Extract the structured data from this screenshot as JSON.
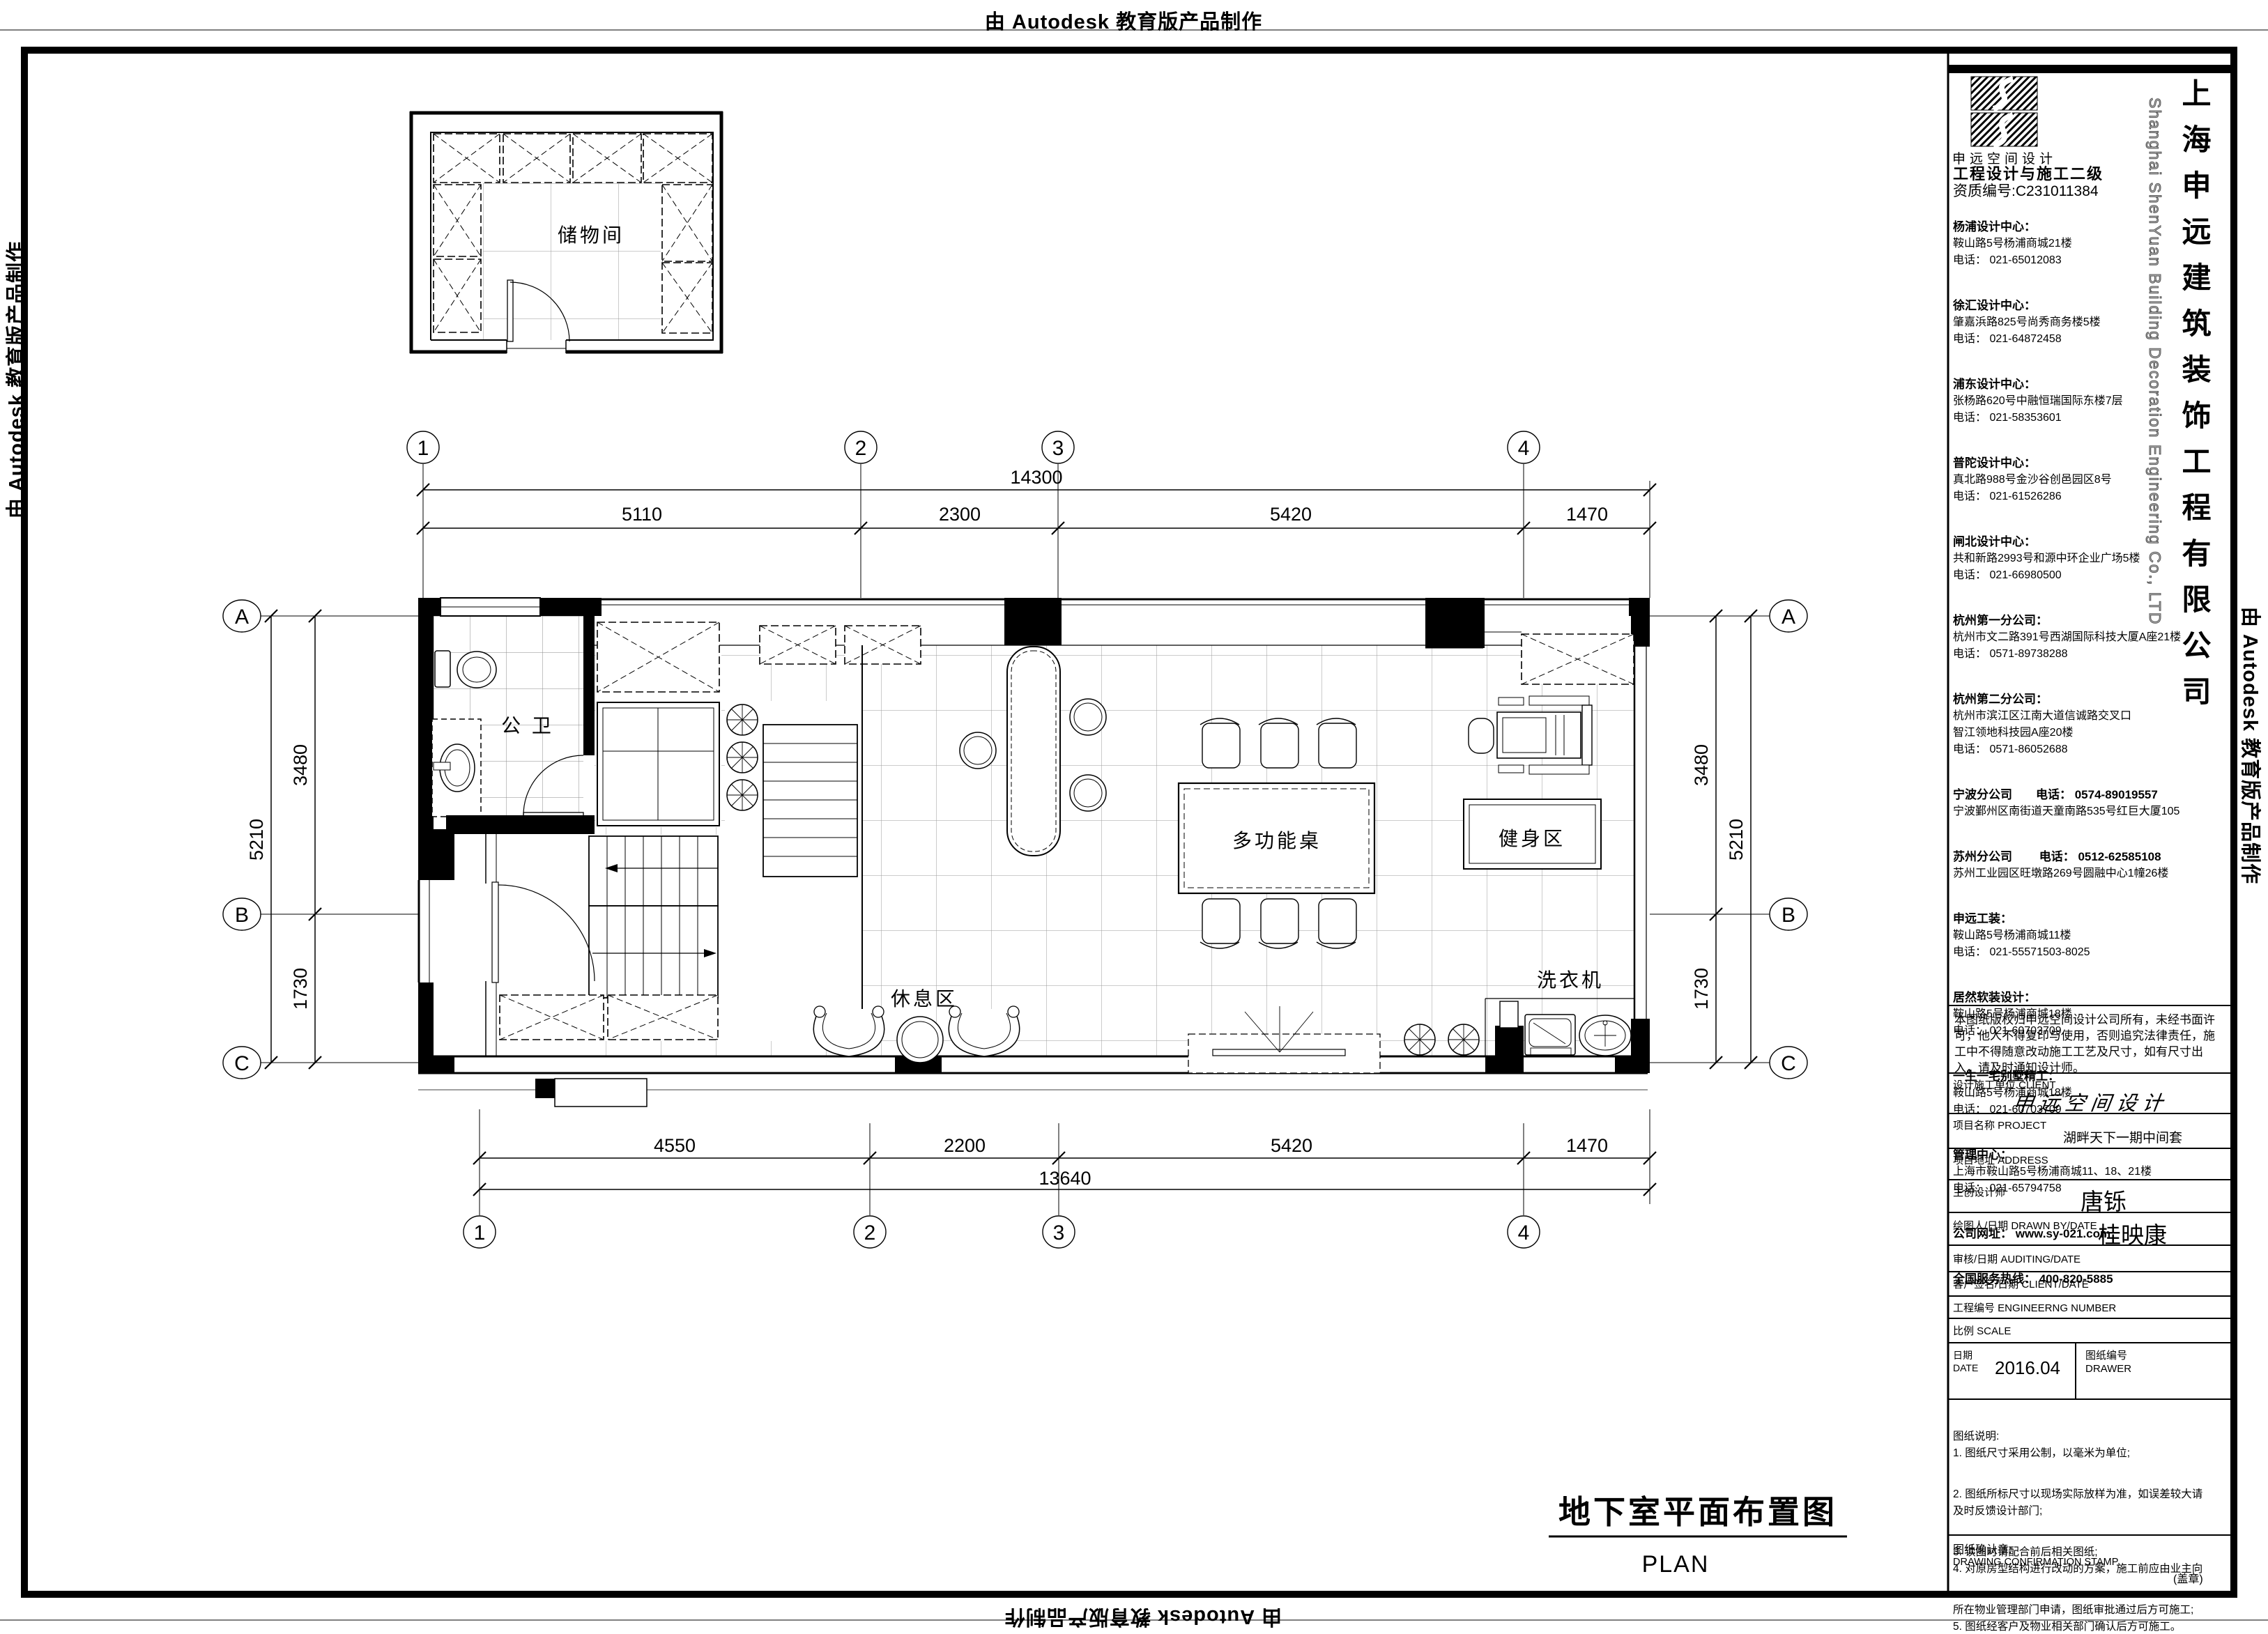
{
  "watermark": {
    "text": "由 Autodesk 教育版产品制作"
  },
  "sheet": {
    "title": "地下室平面布置图",
    "subtitle": "PLAN"
  },
  "plan": {
    "rooms": {
      "storage": "储物间",
      "bath": "公 卫",
      "table": "多功能桌",
      "gym": "健身区",
      "rest": "休息区",
      "washer": "洗衣机"
    },
    "grid": {
      "cols": [
        "1",
        "2",
        "3",
        "4"
      ],
      "rows": [
        "A",
        "B",
        "C"
      ]
    },
    "dims": {
      "top": {
        "overall": "14300",
        "segs": [
          "5110",
          "2300",
          "5420",
          "1470"
        ]
      },
      "bottom": {
        "overall": "13640",
        "segs": [
          "4550",
          "2200",
          "5420",
          "1470"
        ]
      },
      "left": {
        "overall": "5210",
        "segs": [
          "3480",
          "1730"
        ]
      },
      "right": {
        "overall": "5210",
        "segs": [
          "3480",
          "1730"
        ]
      }
    }
  },
  "title_block": {
    "logo_caption": "申远空间设计",
    "cert_line1": "工程设计与施工二级",
    "cert_line2": "资质编号:C231011384",
    "company_cn": "上海申远建筑装饰工程有限公司",
    "company_en": "Shanghai ShenYuan Building Decoration Engineering Co., LTD",
    "offices": [
      {
        "t": "杨浦设计中心：",
        "lines": [
          "鞍山路5号杨浦商城21楼",
          "电话： 021-65012083"
        ]
      },
      {
        "t": "徐汇设计中心：",
        "lines": [
          "肇嘉浜路825号尚秀商务楼5楼",
          "电话： 021-64872458"
        ]
      },
      {
        "t": "浦东设计中心：",
        "lines": [
          "张杨路620号中融恒瑞国际东楼7层",
          "电话： 021-58353601"
        ]
      },
      {
        "t": "普陀设计中心：",
        "lines": [
          "真北路988号金沙谷创邑园区8号",
          "电话： 021-61526286"
        ]
      },
      {
        "t": "闸北设计中心：",
        "lines": [
          "共和新路2993号和源中环企业广场5楼",
          "电话： 021-66980500"
        ]
      },
      {
        "t": "杭州第一分公司：",
        "lines": [
          "杭州市文二路391号西湖国际科技大厦A座21楼",
          "电话： 0571-89738288"
        ]
      },
      {
        "t": "杭州第二分公司：",
        "lines": [
          "杭州市滨江区江南大道信诚路交叉口",
          "智江领地科技园A座20楼",
          "电话： 0571-86052688"
        ]
      },
      {
        "t": "宁波分公司　　电话： 0574-89019557",
        "lines": [
          "宁波鄞州区南街道天童南路535号红巨大厦105"
        ]
      },
      {
        "t": "苏州分公司　　 电话： 0512-62585108",
        "lines": [
          "苏州工业园区旺墩路269号圆融中心1幢26楼"
        ]
      },
      {
        "t": "申远工装：",
        "lines": [
          "鞍山路5号杨浦商城11楼",
          "电话： 021-55571503-8025"
        ]
      },
      {
        "t": "居然软装设计：",
        "lines": [
          "鞍山路5号杨浦商城18楼",
          "电话： 021-60703709"
        ]
      },
      {
        "t": "一生一宅别墅精工：",
        "lines": [
          "鞍山路5号杨浦商城18楼",
          "电话： 021-60703709"
        ]
      },
      {
        "t": "管理中心：",
        "lines": [
          "上海市鞍山路5号杨浦商城11、18、21楼",
          "电话： 021-65794758"
        ]
      },
      {
        "t": "公司网址： www.sy-021.com",
        "lines": []
      },
      {
        "t": "全国服务热线： 400-820-5885",
        "lines": []
      }
    ],
    "copyright": "本图纸版权归申远空间设计公司所有，未经书面许可，他人不得复印与使用，否则追究法律责任，施工中不得随意改动施工工艺及尺寸，如有尺寸出入，请及时通知设计师。",
    "client_label": "设计施工单位 CLIENT",
    "client_value": "申远空间设计",
    "project_label": "项目名称 PROJECT",
    "project_value": "湖畔天下一期中间套",
    "address_label": "项目地址 ADDRESS",
    "designer_label": "主创设计师",
    "designer_value": "唐铄",
    "drawnby_label": "绘图人/日期 DRAWN BY/DATE",
    "drawnby_value": "桂映康",
    "audit_label": "审核/日期 AUDITING/DATE",
    "sign_label": "客户签名/日期 CLIENT/DATE",
    "number_label": "工程编号 ENGINEERNG NUMBER",
    "scale_label": "比例 SCALE",
    "date_label_cn": "日期",
    "date_label_en": "DATE",
    "date_value": "2016.04",
    "sheetno_label_cn": "图纸编号",
    "sheetno_label_en": "DRAWER",
    "notes": [
      "图纸说明:",
      "1. 图纸尺寸采用公制，以毫米为单位;",
      "2. 图纸所标尺寸以现场实际放样为准，如误差较大请",
      "及时反馈设计部门;",
      "3. 读图时请配合前后相关图纸;",
      "4. 对原房型结构进行改动的方案，施工前应由业主向",
      "所在物业管理部门申请，图纸审批通过后方可施工;",
      "5. 图纸经客户及物业相关部门确认后方可施工。"
    ],
    "stamp_cn": "图纸确认章:",
    "stamp_en": "DRAWING CONFIRMATION STAMP",
    "stamp_seal": "(盖章)"
  }
}
